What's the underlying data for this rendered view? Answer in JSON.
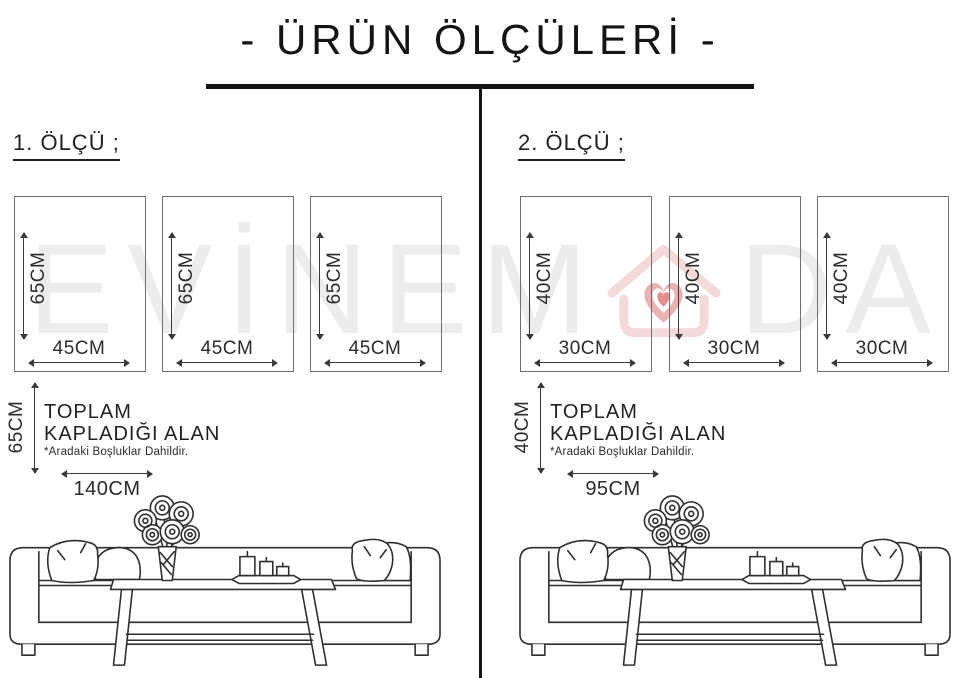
{
  "title": {
    "text": "- ÜRÜN ÖLÇÜLERİ -"
  },
  "watermark": {
    "letters": [
      "E",
      "V",
      "İ",
      "N",
      "E",
      "M",
      "D",
      "A"
    ],
    "logo": "house-with-heart",
    "letter_color": "#ececec",
    "logo_outline_color": "#f4d9d9",
    "logo_heart_color": "#eab3b3"
  },
  "sections": [
    {
      "heading": "1. ÖLÇÜ ;",
      "panels": [
        {
          "height": "65CM",
          "width": "45CM"
        },
        {
          "height": "65CM",
          "width": "45CM"
        },
        {
          "height": "65CM",
          "width": "45CM"
        }
      ],
      "total": {
        "height": "65CM",
        "line1": "TOPLAM",
        "line2": "KAPLADIĞI ALAN",
        "note": "*Aradaki Boşluklar Dahildir.",
        "width": "140CM"
      }
    },
    {
      "heading": "2. ÖLÇÜ ;",
      "panels": [
        {
          "height": "40CM",
          "width": "30CM"
        },
        {
          "height": "40CM",
          "width": "30CM"
        },
        {
          "height": "40CM",
          "width": "30CM"
        }
      ],
      "total": {
        "height": "40CM",
        "line1": "TOPLAM",
        "line2": "KAPLADIĞI ALAN",
        "note": "*Aradaki Boşluklar Dahildir.",
        "width": "95CM"
      }
    }
  ]
}
